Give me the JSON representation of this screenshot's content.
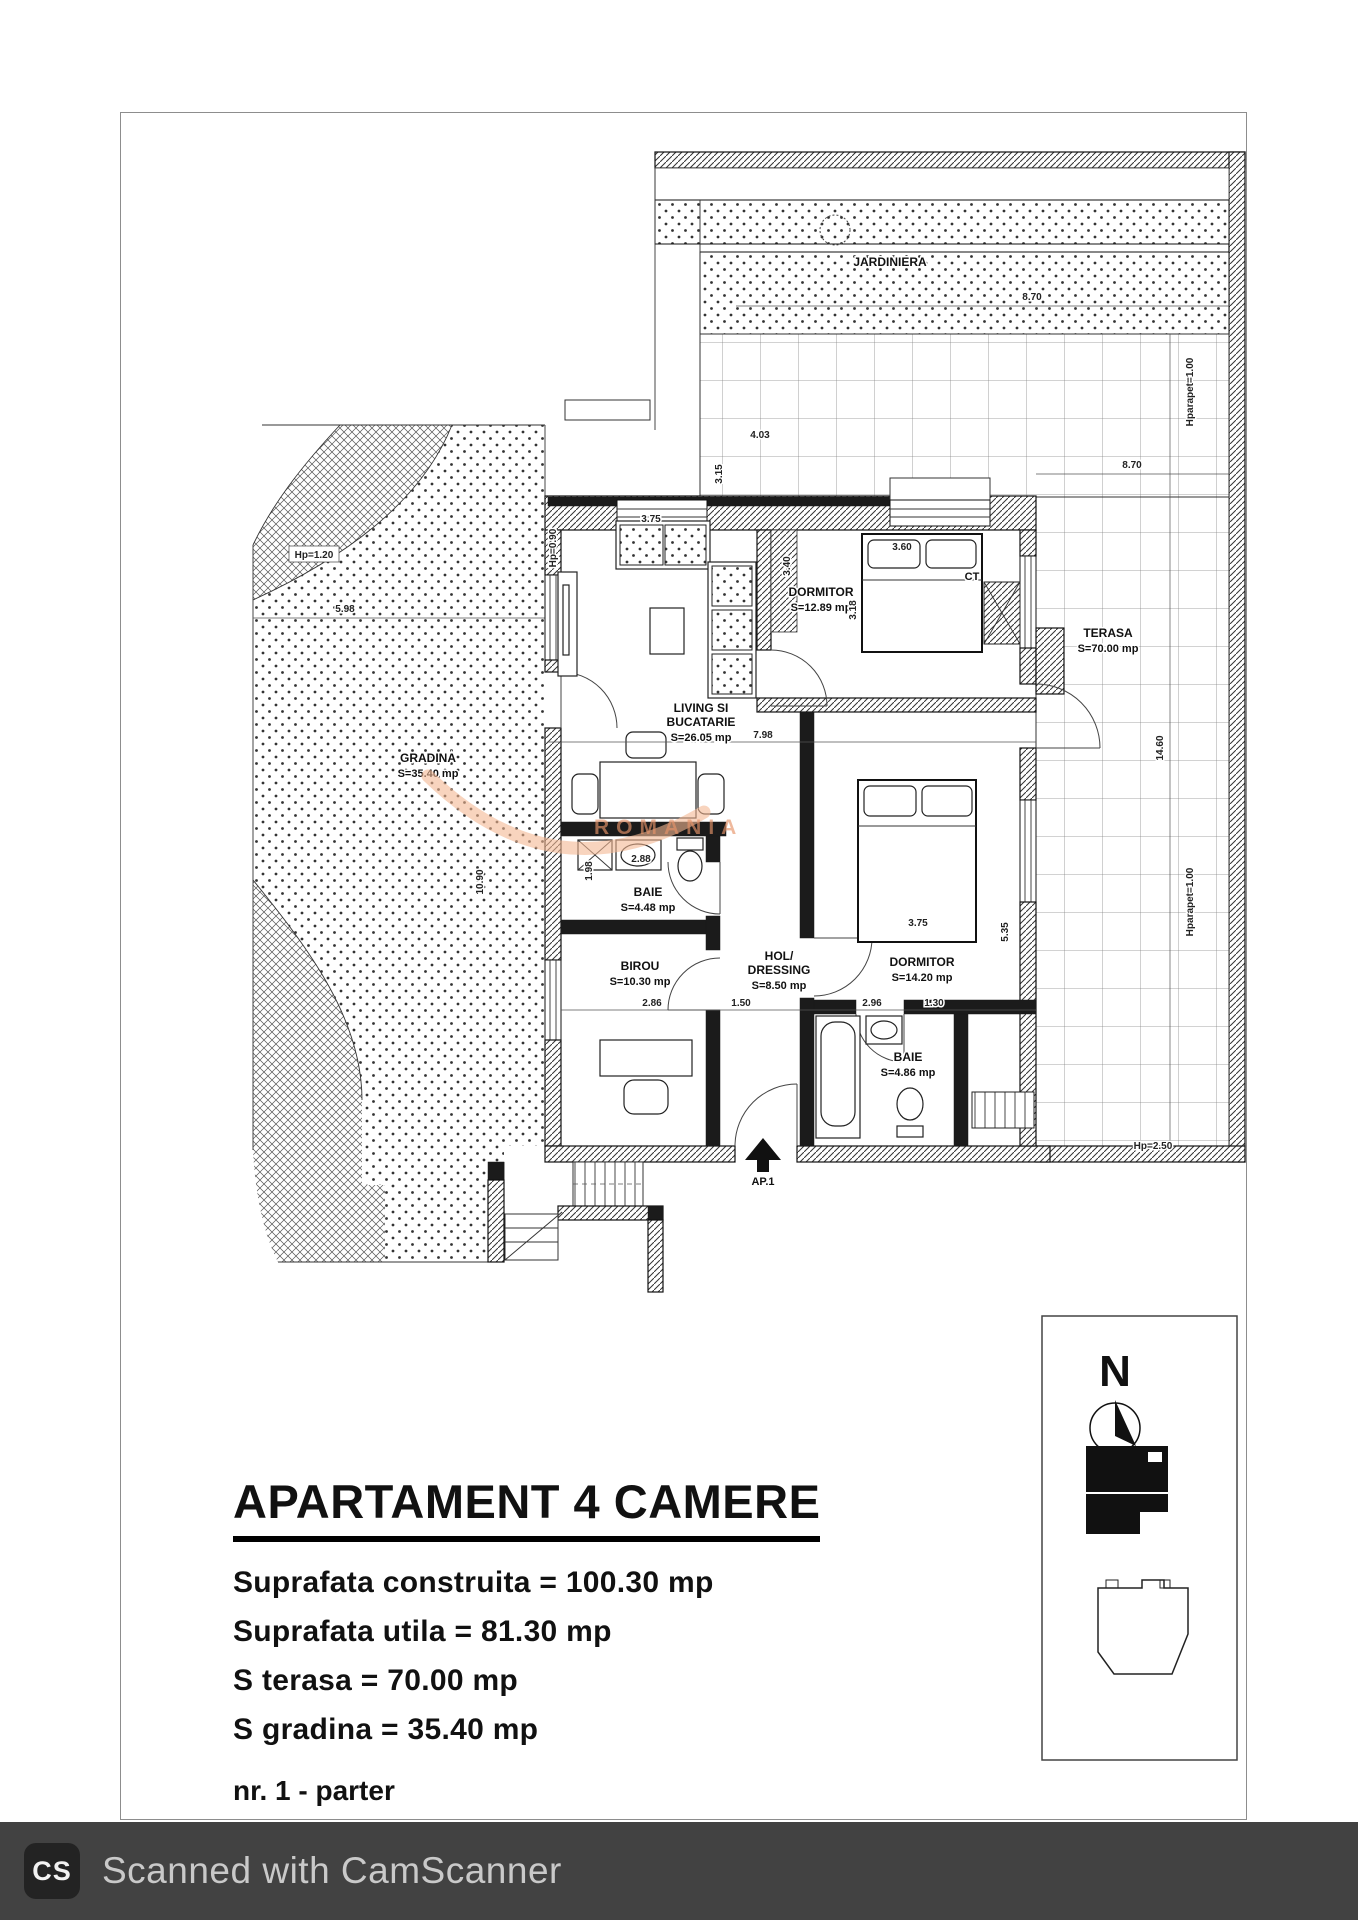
{
  "title_block": {
    "title": "APARTAMENT 4 CAMERE",
    "line1": "Suprafata construita = 100.30 mp",
    "line2": "Suprafata utila = 81.30 mp",
    "line3": "S terasa = 70.00 mp",
    "line4": "S gradina = 35.40 mp",
    "unit": "nr. 1 - parter"
  },
  "rooms": {
    "living": {
      "l1": "LIVING SI",
      "l2": "BUCATARIE",
      "area": "S=26.05 mp"
    },
    "dormitor1": {
      "l1": "DORMITOR",
      "area": "S=12.89 mp"
    },
    "dormitor2": {
      "l1": "DORMITOR",
      "area": "S=14.20 mp"
    },
    "baie1": {
      "l1": "BAIE",
      "area": "S=4.48 mp"
    },
    "baie2": {
      "l1": "BAIE",
      "area": "S=4.86 mp"
    },
    "birou": {
      "l1": "BIROU",
      "area": "S=10.30 mp"
    },
    "hol": {
      "l1": "HOL/",
      "l2": "DRESSING",
      "area": "S=8.50 mp"
    },
    "terasa": {
      "l1": "TERASA",
      "area": "S=70.00 mp"
    },
    "gradina": {
      "l1": "GRADINA",
      "area": "S=35.40 mp"
    },
    "jardiniera": {
      "l1": "JARDINIERA"
    }
  },
  "plan_labels": {
    "ct": "CT",
    "entrance": "AP.1"
  },
  "dims": [
    "3.75",
    "4.03",
    "3.15",
    "3.40",
    "3.60",
    "7.98",
    "8.70",
    "8.70",
    "14.60",
    "Hparapet=1.00",
    "Hparapet=1.00",
    "Hp=0.90",
    "Hp=1.20",
    "5.98",
    "2.88",
    "1.98",
    "2.86",
    "1.50",
    "2.96",
    "1.30",
    "3.75",
    "5.35",
    "Hp=2.50",
    "10.90",
    "3.18"
  ],
  "compass": {
    "north": "N"
  },
  "watermark": {
    "text": "ROMANIA"
  },
  "footer": {
    "logo": "CS",
    "text": "Scanned with CamScanner"
  },
  "colors": {
    "accent_watermark": "#f3b893",
    "footer_bg": "#424242",
    "footer_text": "#c9c9c9",
    "ink": "#111111"
  }
}
